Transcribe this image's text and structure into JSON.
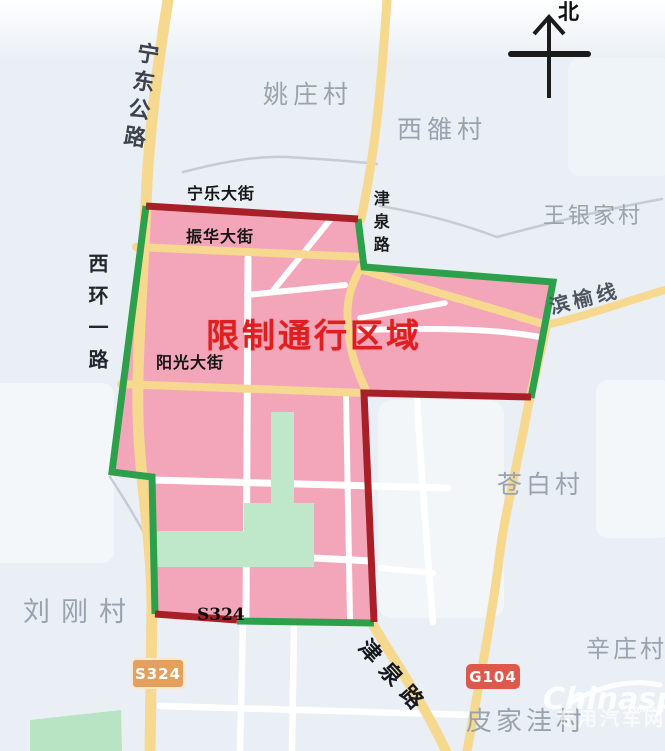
{
  "map": {
    "compass": {
      "north_label": "北"
    },
    "restricted_zone": {
      "title": "限制通行区域"
    },
    "villages": {
      "yaozhuang": "姚庄村",
      "xiluo": "西雒村",
      "wangyinjia": "王银家村",
      "cangbai": "苍白村",
      "liugang": "刘刚村",
      "xinzhuang": "辛庄村",
      "pijiawa": "皮家洼村"
    },
    "roads": {
      "ningdong_highway": "宁东公路",
      "ningle_street": "宁乐大街",
      "jinquan_road_top": "津泉路",
      "zhenhua_street": "振华大街",
      "xihuan_first_road": "西环一路",
      "binyu_line": "滨榆线",
      "yangguang_street": "阳光大街",
      "s324_text": "S324",
      "jinquan_road_bottom": "津泉路"
    },
    "badges": {
      "s324": "S324",
      "g104": "G104"
    },
    "watermark": {
      "brand": "Chinaspv",
      "domain": "com.cn",
      "caption": "专用汽车网"
    },
    "colors": {
      "zone_fill": "#f3a1b6",
      "border_green": "#2da04b",
      "border_red": "#a91f28",
      "road_yellow": "#f6d88f",
      "park_green": "#bfe8ca",
      "title_red": "#df1f1f",
      "village_gray": "#98a3ae",
      "badge_s324": "#e3a05e",
      "badge_g104": "#de584c"
    }
  }
}
